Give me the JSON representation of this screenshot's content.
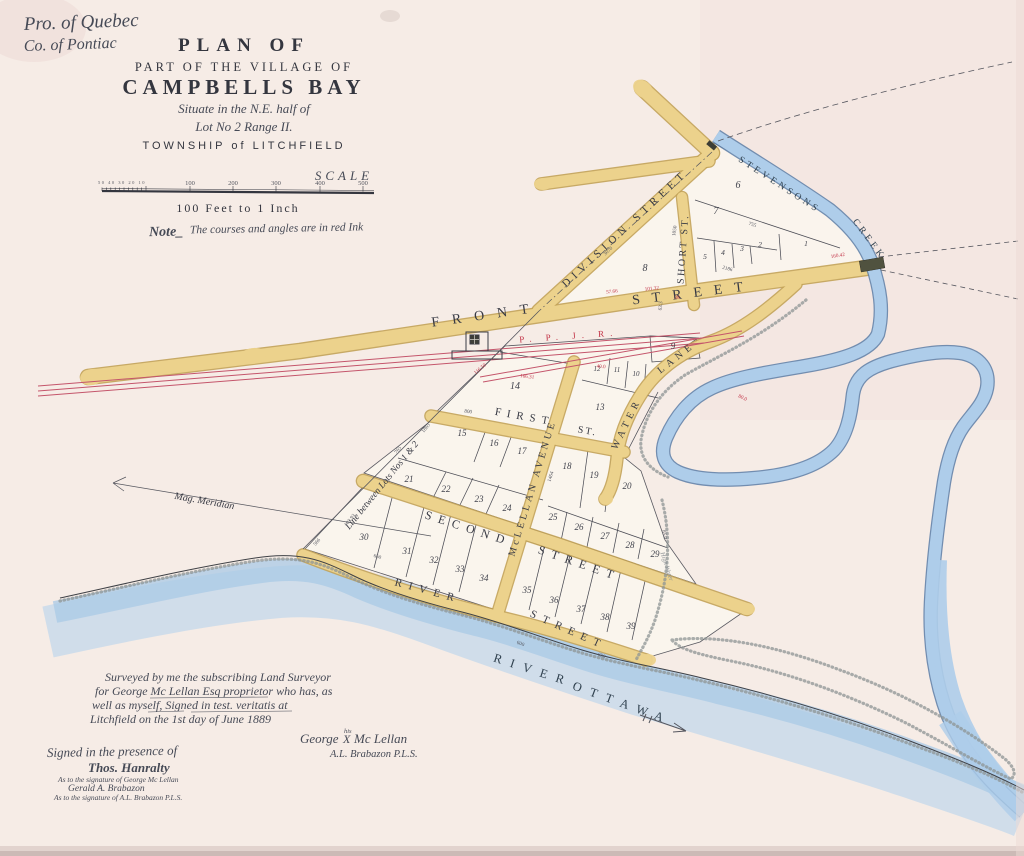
{
  "header": {
    "province": "Pro. of Quebec",
    "county": "Co. of Pontiac"
  },
  "title": {
    "plan_of": "PLAN OF",
    "part_of": "PART OF THE VILLAGE OF",
    "name": "CAMPBELLS BAY",
    "situate": "Situate in the N.E. half of",
    "lot": "Lot No 2 Range II.",
    "township": "TOWNSHIP of LITCHFIELD"
  },
  "scale": {
    "label": "SCALE",
    "unit_numbers": [
      "100",
      "200",
      "300",
      "400",
      "500"
    ],
    "sub_numbers": "50 40 30 20 10",
    "caption": "100 Feet to 1 Inch"
  },
  "note": {
    "prefix": "Note_",
    "body": "The courses and angles are in red Ink"
  },
  "map": {
    "colors": {
      "street": "#ecd28c",
      "street_edge": "#c2a256",
      "water": "#aecdea",
      "water_edge": "#5a7da6",
      "rail": "#c4556b",
      "ink": "#3a3c45",
      "red_ink": "#c23246"
    },
    "street_labels": [
      {
        "id": "front-1",
        "text": "FRONT",
        "x": 487,
        "y": 319,
        "r": -8,
        "s": 14,
        "sp": 13
      },
      {
        "id": "front-2",
        "text": "STREET",
        "x": 694,
        "y": 297,
        "r": -7,
        "s": 14,
        "sp": 12
      },
      {
        "id": "division",
        "text": "DIVISION STREET",
        "x": 627,
        "y": 231,
        "r": -43,
        "s": 11,
        "sp": 5
      },
      {
        "id": "short",
        "text": "SHORT ST.",
        "x": 686,
        "y": 249,
        "r": -86,
        "s": 10,
        "sp": 2.5
      },
      {
        "id": "first",
        "text": "FIRST",
        "x": 524,
        "y": 420,
        "r": 10,
        "s": 11,
        "sp": 6
      },
      {
        "id": "first-st",
        "text": "ST.",
        "x": 587,
        "y": 434,
        "r": 10,
        "s": 10,
        "sp": 2
      },
      {
        "id": "mclellan",
        "text": "McLELLAN AVENUE",
        "x": 535,
        "y": 489,
        "r": -73,
        "s": 10,
        "sp": 3.2
      },
      {
        "id": "second",
        "text": "SECOND",
        "x": 467,
        "y": 532,
        "r": 18,
        "s": 12,
        "sp": 7
      },
      {
        "id": "second-2",
        "text": "STREET",
        "x": 578,
        "y": 567,
        "r": 19,
        "s": 12,
        "sp": 7
      },
      {
        "id": "river-street",
        "text": "RIVER",
        "x": 427,
        "y": 594,
        "r": 15,
        "s": 11,
        "sp": 7
      },
      {
        "id": "river-street-2",
        "text": "STREET",
        "x": 567,
        "y": 633,
        "r": 24,
        "s": 11,
        "sp": 7
      },
      {
        "id": "water-lane-1",
        "text": "WATER",
        "x": 629,
        "y": 425,
        "r": -64,
        "s": 10,
        "sp": 4.5
      },
      {
        "id": "water-lane-2",
        "text": "LANE",
        "x": 678,
        "y": 360,
        "r": -38,
        "s": 10,
        "sp": 4.5
      }
    ],
    "water_labels": [
      {
        "id": "stevensons",
        "text": "STEVENSONS",
        "x": 778,
        "y": 187,
        "r": 33,
        "s": 9.5,
        "sp": 3.5
      },
      {
        "id": "creek",
        "text": "CREEK",
        "x": 867,
        "y": 241,
        "r": 53,
        "s": 9.5,
        "sp": 3.5
      },
      {
        "id": "river-ottawa-1",
        "text": "RIVER",
        "x": 532,
        "y": 674,
        "r": 18,
        "s": 12.5,
        "sp": 9
      },
      {
        "id": "river-ottawa-2",
        "text": "OTTAWA",
        "x": 621,
        "y": 707,
        "r": 20,
        "s": 12.5,
        "sp": 9
      }
    ],
    "misc_labels": [
      {
        "id": "ppjr",
        "text": "P. P. J. R.",
        "x": 569,
        "y": 339,
        "r": -4,
        "s": 9,
        "sp": 6,
        "red": true
      },
      {
        "id": "mag-meridian",
        "text": "Mag. Meridian",
        "x": 204,
        "y": 504,
        "r": 10,
        "s": 10,
        "italic": true
      },
      {
        "id": "lots-line",
        "text": "Line between Lots Nos 1 & 2",
        "x": 384,
        "y": 487,
        "r": -51,
        "s": 9.5,
        "italic": true
      },
      {
        "id": "high-water",
        "text": "High Water",
        "x": 665,
        "y": 567,
        "r": 72,
        "s": 6.5,
        "italic": true,
        "grey": true
      }
    ],
    "lots": [
      {
        "n": "1",
        "x": 806,
        "y": 246,
        "s": 7.5
      },
      {
        "n": "2",
        "x": 760,
        "y": 247,
        "s": 7.5
      },
      {
        "n": "3",
        "x": 742,
        "y": 251,
        "s": 7.5
      },
      {
        "n": "4",
        "x": 723,
        "y": 255,
        "s": 7.5
      },
      {
        "n": "5",
        "x": 705,
        "y": 259,
        "s": 7.5
      },
      {
        "n": "6",
        "x": 738,
        "y": 188,
        "s": 10
      },
      {
        "n": "7",
        "x": 716,
        "y": 214,
        "s": 10
      },
      {
        "n": "8",
        "x": 645,
        "y": 271,
        "s": 10
      },
      {
        "n": "9",
        "x": 673,
        "y": 349
      },
      {
        "n": "10",
        "x": 636,
        "y": 376,
        "s": 7
      },
      {
        "n": "11",
        "x": 617,
        "y": 372,
        "s": 7
      },
      {
        "n": "12",
        "x": 597,
        "y": 371,
        "s": 7
      },
      {
        "n": "13",
        "x": 600,
        "y": 410
      },
      {
        "n": "14",
        "x": 515,
        "y": 389,
        "s": 10
      },
      {
        "n": "15",
        "x": 462,
        "y": 436
      },
      {
        "n": "16",
        "x": 494,
        "y": 446
      },
      {
        "n": "17",
        "x": 522,
        "y": 454
      },
      {
        "n": "18",
        "x": 567,
        "y": 469
      },
      {
        "n": "19",
        "x": 594,
        "y": 478
      },
      {
        "n": "20",
        "x": 627,
        "y": 489
      },
      {
        "n": "21",
        "x": 409,
        "y": 482
      },
      {
        "n": "22",
        "x": 446,
        "y": 492
      },
      {
        "n": "23",
        "x": 479,
        "y": 502
      },
      {
        "n": "24",
        "x": 507,
        "y": 511
      },
      {
        "n": "25",
        "x": 553,
        "y": 520
      },
      {
        "n": "26",
        "x": 579,
        "y": 530
      },
      {
        "n": "27",
        "x": 605,
        "y": 539
      },
      {
        "n": "28",
        "x": 630,
        "y": 548
      },
      {
        "n": "29",
        "x": 655,
        "y": 557
      },
      {
        "n": "30",
        "x": 364,
        "y": 540
      },
      {
        "n": "31",
        "x": 407,
        "y": 554
      },
      {
        "n": "32",
        "x": 434,
        "y": 563
      },
      {
        "n": "33",
        "x": 460,
        "y": 572
      },
      {
        "n": "34",
        "x": 484,
        "y": 581
      },
      {
        "n": "35",
        "x": 527,
        "y": 593
      },
      {
        "n": "36",
        "x": 554,
        "y": 603
      },
      {
        "n": "37",
        "x": 581,
        "y": 612
      },
      {
        "n": "38",
        "x": 605,
        "y": 620
      },
      {
        "n": "39",
        "x": 631,
        "y": 629
      }
    ],
    "dims_black": [
      {
        "t": "1865",
        "x": 427,
        "y": 429,
        "r": -50
      },
      {
        "t": "765",
        "x": 399,
        "y": 451,
        "r": -50
      },
      {
        "t": "800",
        "x": 468,
        "y": 413,
        "r": 8
      },
      {
        "t": "1050",
        "x": 676,
        "y": 231,
        "r": -82
      },
      {
        "t": "3070",
        "x": 609,
        "y": 252,
        "r": -44
      },
      {
        "t": "63.3",
        "x": 662,
        "y": 306,
        "r": -85
      },
      {
        "t": "660",
        "x": 377,
        "y": 558,
        "r": 15
      },
      {
        "t": "600",
        "x": 520,
        "y": 645,
        "r": 20
      },
      {
        "t": "650",
        "x": 601,
        "y": 657,
        "r": 22
      },
      {
        "t": "85.0",
        "x": 663,
        "y": 535,
        "r": 78
      },
      {
        "t": "103.93",
        "x": 351,
        "y": 521,
        "r": -50
      },
      {
        "t": "1464",
        "x": 552,
        "y": 477,
        "r": -73
      },
      {
        "t": "755",
        "x": 752,
        "y": 226,
        "r": 18
      },
      {
        "t": "2186",
        "x": 727,
        "y": 270,
        "r": 15
      },
      {
        "t": "566",
        "x": 318,
        "y": 543,
        "r": -50
      }
    ],
    "dims_red": [
      {
        "t": "116.50",
        "x": 481,
        "y": 370,
        "r": -40
      },
      {
        "t": "166.31",
        "x": 527,
        "y": 378,
        "r": 7
      },
      {
        "t": "57.66",
        "x": 612,
        "y": 293,
        "r": -6
      },
      {
        "t": "101.32",
        "x": 652,
        "y": 290,
        "r": -6
      },
      {
        "t": "160.42",
        "x": 838,
        "y": 257,
        "r": -9
      },
      {
        "t": "40.0",
        "x": 601,
        "y": 368,
        "r": 5
      },
      {
        "t": "38",
        "x": 677,
        "y": 299,
        "r": 0
      },
      {
        "t": "80.0",
        "x": 742,
        "y": 399,
        "r": 25
      }
    ]
  },
  "attestation": {
    "lines": [
      "Surveyed by me the subscribing Land Surveyor",
      "for George Mc Lellan Esq proprietor who has, as",
      "well as myself, Signed in test. veritatis at",
      "Litchfield on the 1st day of June 1889"
    ]
  },
  "signatures": {
    "principal_first": "George",
    "principal_mark_note": "his",
    "principal_mark": "X",
    "principal_last": "Mc Lellan",
    "surveyor": "A.L. Brabazon P.L.S.",
    "witness_heading": "Signed in the presence of",
    "witness_name": "Thos. Hanralty",
    "witness_note1": "As to the signature of George Mc Lellan",
    "witness2_name": "Gerald A. Brabazon",
    "witness_note2": "As to the signature of A.L. Brabazon P.L.S."
  }
}
